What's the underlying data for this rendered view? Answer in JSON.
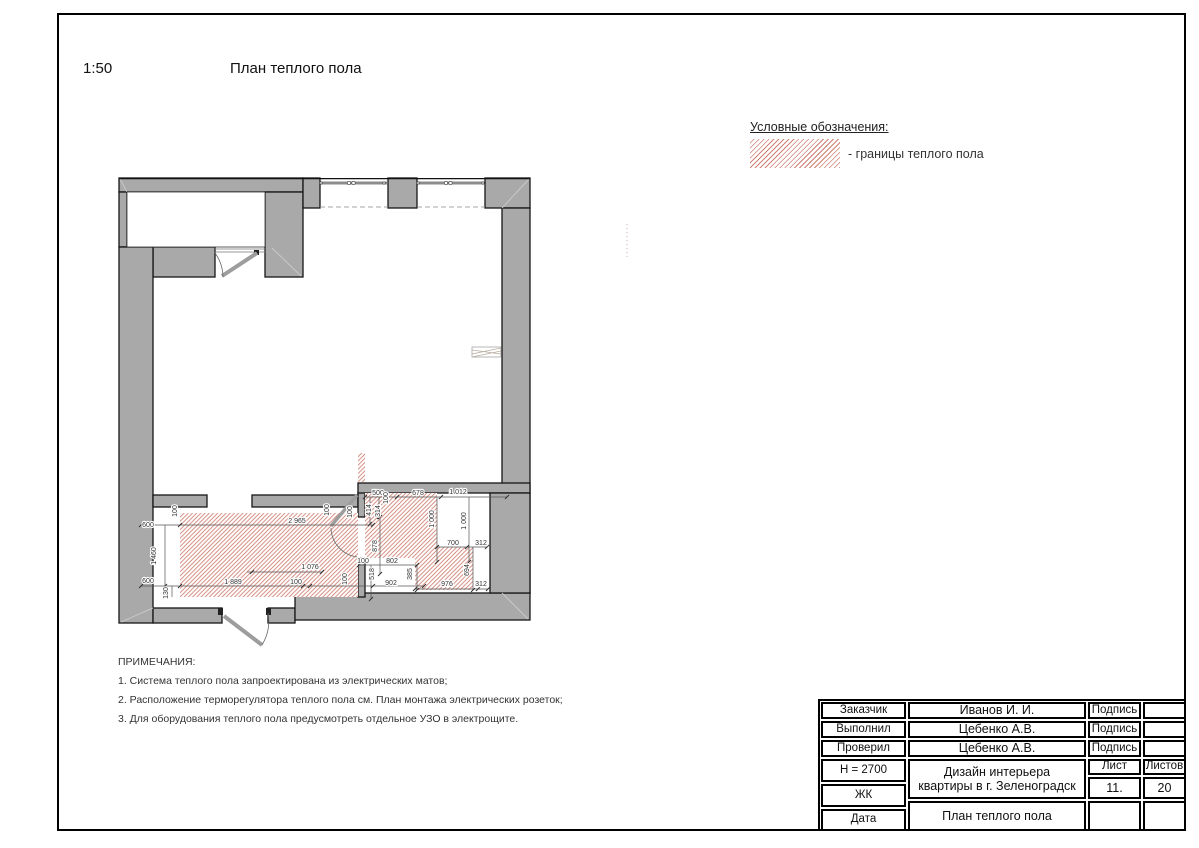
{
  "sheet": {
    "scale": "1:50",
    "title": "План теплого пола"
  },
  "legend": {
    "title": "Условные обозначения:",
    "item": "- границы теплого пола"
  },
  "notes": {
    "heading": "ПРИМЕЧАНИЯ:",
    "items": [
      "1. Система теплого пола запроектирована из электрических матов;",
      "2. Расположение терморегулятора теплого пола см. План монтажа электрических розеток;",
      "3. Для оборудования теплого пола предусмотреть отдельное УЗО в электрощите."
    ]
  },
  "plan": {
    "dims": [
      "600",
      "1 460",
      "600",
      "130",
      "100",
      "2 965",
      "1 889",
      "100",
      "1 076",
      "100",
      "100",
      "100",
      "500",
      "678",
      "1 012",
      "414",
      "314",
      "100",
      "878",
      "1 000",
      "1 000",
      "700",
      "312",
      "694",
      "976",
      "312",
      "100",
      "802",
      "518",
      "902",
      "385"
    ]
  },
  "title_block": {
    "rows": [
      {
        "label": "Заказчик",
        "value": "Иванов И. И.",
        "sign": "Подпись"
      },
      {
        "label": "Выполнил",
        "value": "Цебенко А.В.",
        "sign": "Подпись"
      },
      {
        "label": "Проверил",
        "value": "Цебенко А.В.",
        "sign": "Подпись"
      }
    ],
    "height": "H = 2700",
    "zhk": "ЖК",
    "date_label": "Дата",
    "project": "Дизайн интерьера квартиры в г. Зеленоградск",
    "drawing_title": "План теплого пола",
    "sheet_label": "Лист",
    "sheets_label": "Листов",
    "sheet_no": "11.",
    "sheets_total": "20"
  },
  "colors": {
    "hatch": "#cf7f73",
    "wall": "#a9a9a9",
    "outline": "#161616"
  }
}
